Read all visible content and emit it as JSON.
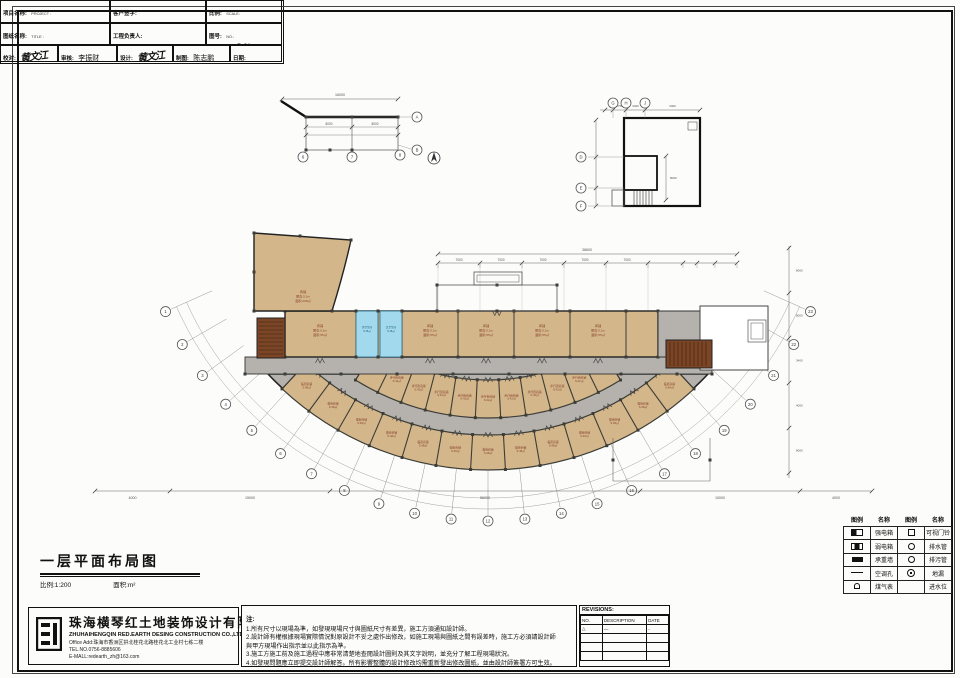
{
  "sheet": {
    "title": "一层平面布局图",
    "scale_note": "比例:1:200",
    "area_note": "面积:m²"
  },
  "company": {
    "name_cn": "珠海横琴红土地装饰设计有限公司",
    "name_en": "ZHUHAIHENGQIN RED.EARTH DESING CONSTRUCTION CO.,LTD",
    "address": "Office Add:珠海市香洲区拱北桂花北路桂花北工业村七栋二楼",
    "tel": "TEL.NO.0756-8885606",
    "email": "E-MALL:redearth_zh@163.com"
  },
  "notes": {
    "heading": "注:",
    "lines": [
      "1.所有尺寸以現場為準，如發現現場尺寸與圖紙尺寸有差異，施工方須通知設計師。",
      "2.設計師有權根據現場實際情況對原設計不妥之處作出修改，如施工現場與圖紙之間有誤差時，施工方必須請設計師",
      "與甲方現場作出指示並以此指示為準。",
      "3.施工方施工前及施工過程中應非常清楚地查閱設計圖則及其文字說明，並充分了解工程現場狀況。",
      "4.如發現問題應立即提交設計師解答。所有影響整體的設計修改均需重新發出修改圖紙，並由設計師簽署方可生效。"
    ]
  },
  "revisions": {
    "title": "REVISIONS:",
    "columns": [
      "NO.",
      "DESCRIPTION",
      "DATE"
    ],
    "rows": [
      {
        "no": "△",
        "desc": "—",
        "date": "-"
      },
      {
        "no": "",
        "desc": "",
        "date": ""
      },
      {
        "no": "",
        "desc": "",
        "date": ""
      },
      {
        "no": "",
        "desc": "",
        "date": ""
      }
    ]
  },
  "title_block": {
    "project_label": "项目名称:",
    "project_label_en": "PROJECT :",
    "project_value": "恒健智能制造产业基地-3号楼",
    "drawing_label": "图纸名称:",
    "drawing_label_en": "TITLE :",
    "drawing_value": "一层平面布局图",
    "client_label": "客户签字:",
    "pm_label": "工程负责人:",
    "scale_label": "比例:",
    "scale_label_en": "SCALE:",
    "scale_value": "见图",
    "no_label": "图号:",
    "no_label_en": "NO.:",
    "no_value": "P-01",
    "check_label": "校对:",
    "check_label_en": "CHECKED:",
    "check_value": "黄文江",
    "approve_label": "审核:",
    "approve_label_en": "APPROVED BY:",
    "approve_value": "李振财",
    "design_label": "设计:",
    "design_label_en": "DESIGNER:",
    "design_value": "黄文江",
    "draw_label": "制图:",
    "draw_label_en": "DRAWN:",
    "draw_value": "陈志鹏",
    "date_label": "日期:",
    "date_label_en": "DATE:",
    "date_value": "2018.08.24"
  },
  "legend": {
    "headers": [
      "图例",
      "名称",
      "图例",
      "名称"
    ],
    "rows": [
      {
        "s1": "box1",
        "n1": "强电箱",
        "s2": "sq",
        "n2": "可视门铃"
      },
      {
        "s1": "box2",
        "n1": "弱电箱",
        "s2": "circ",
        "n2": "排水管"
      },
      {
        "s1": "wall",
        "n1": "承重墙",
        "s2": "circ",
        "n2": "排污管"
      },
      {
        "s1": "hline",
        "n1": "空调孔",
        "s2": "dotc",
        "n2": "地漏"
      },
      {
        "s1": "meter",
        "n1": "煤气表",
        "s2": "blank",
        "n2": "进水位"
      }
    ]
  },
  "plan": {
    "colors": {
      "room": "#d3b68a",
      "corridor": "#b5b2ad",
      "blue_room": "#a3d9ed",
      "stair": "#7b4526",
      "wall": "#3d3d38",
      "label": "#8a4430",
      "blue_label": "#155e77",
      "dim": "#555555"
    },
    "labels": {
      "shop": [
        "商铺",
        "层高:5.1m",
        "面积:55㎡"
      ],
      "big_room": [
        "商铺",
        "层高:5.1m",
        "面积:268㎡"
      ],
      "blue_rooms": [
        [
          "男卫生间",
          "S:18㎡"
        ],
        [
          "女卫生间",
          "S:18㎡"
        ]
      ],
      "arc_inner": [
        "步行街商铺",
        "S:42㎡"
      ],
      "arc_outer": [
        "临街商铺",
        "S:48㎡"
      ]
    },
    "axis_numbers": [
      "1",
      "2",
      "3",
      "4",
      "5",
      "6",
      "7",
      "8",
      "9",
      "10",
      "11",
      "12",
      "13",
      "14",
      "15",
      "16",
      "17",
      "18",
      "19",
      "20",
      "21",
      "22",
      "23"
    ],
    "dims": {
      "top_total": "38600",
      "top_segments": [
        "7000",
        "7000",
        "7000",
        "7000",
        "7000"
      ],
      "bottom_segments": [
        "4000",
        "15000",
        "56000",
        "15000",
        "4000"
      ],
      "right_segments": [
        "8000",
        "8000",
        "3400",
        "4000",
        "8000"
      ]
    },
    "detail_left": {
      "total": "16000",
      "dims": [
        "8000",
        "8000"
      ],
      "bubbles_bottom": [
        "6",
        "7",
        "8"
      ],
      "bubble_a": "A",
      "bubble_b": "B"
    },
    "detail_right": {
      "bubbles_top": [
        "G",
        "H",
        "J"
      ],
      "bubbles_left": [
        "D",
        "E",
        "F"
      ],
      "dims_top": [
        "1750",
        "3400",
        "3400"
      ],
      "dim_side": "8000"
    }
  }
}
